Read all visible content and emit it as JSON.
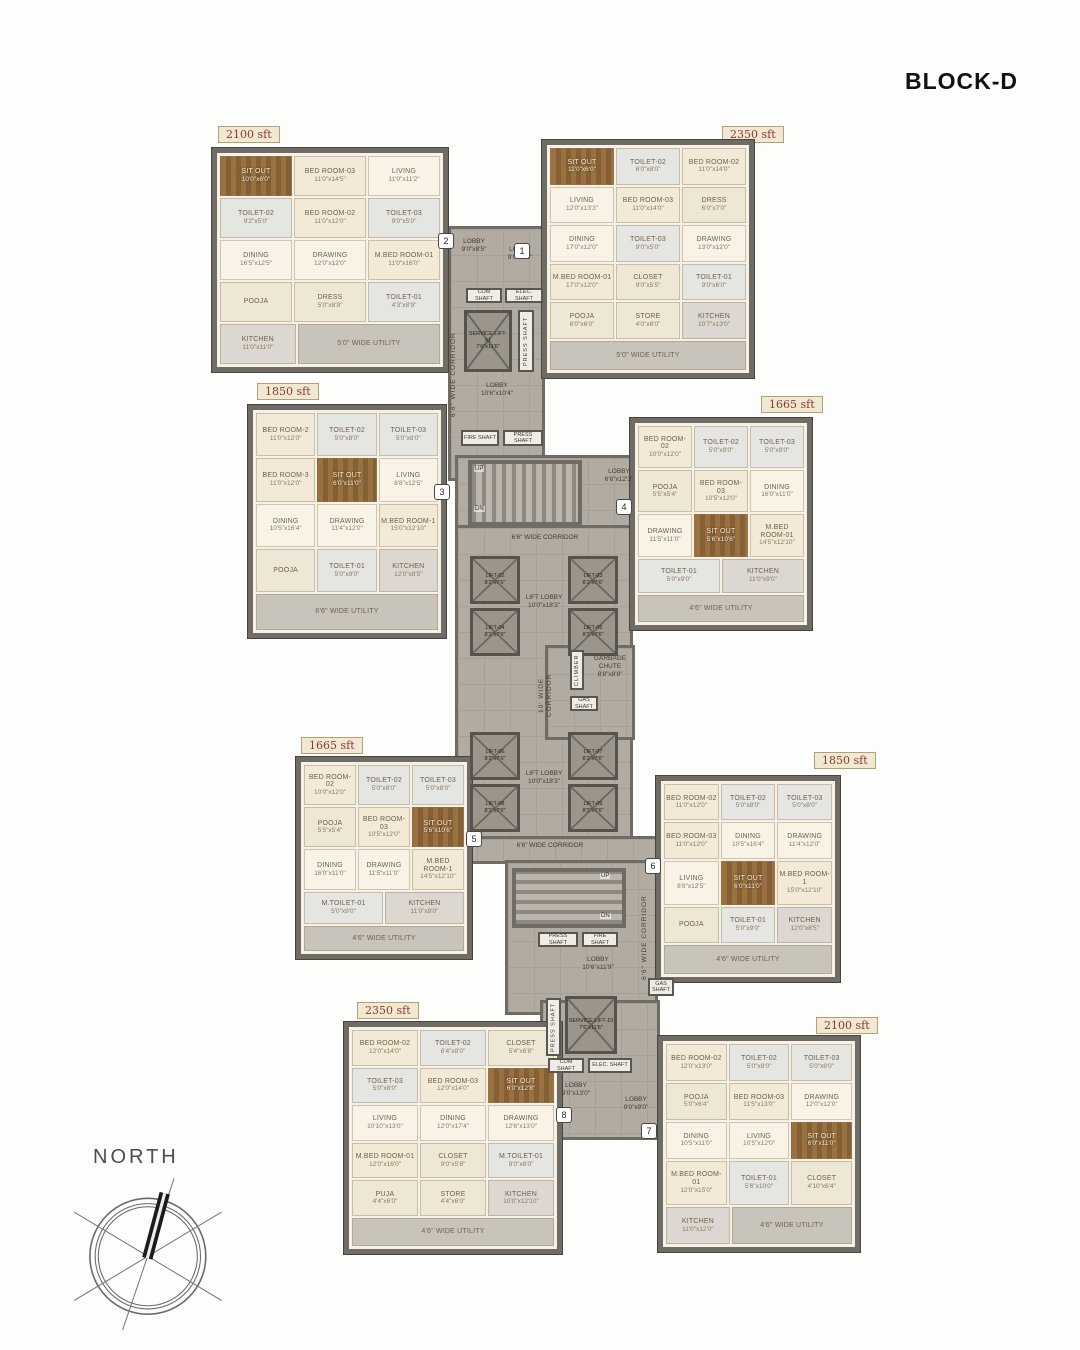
{
  "header": {
    "title": "BLOCK-D"
  },
  "compass": {
    "label": "NORTH"
  },
  "units": [
    {
      "area": "2350 sft",
      "tag": "1",
      "rooms": [
        {
          "n": "SIT OUT",
          "d": "11'0\"x6'0\"",
          "k": "sitout"
        },
        {
          "n": "TOILET-02",
          "d": "6'0\"x8'0\"",
          "k": "toilet"
        },
        {
          "n": "BED ROOM-02",
          "d": "11'0\"x14'0\"",
          "k": "bedroom"
        },
        {
          "n": "LIVING",
          "d": "12'0\"x13'3\"",
          "k": "living"
        },
        {
          "n": "BED ROOM-03",
          "d": "11'0\"x14'0\"",
          "k": "bedroom"
        },
        {
          "n": "DRESS",
          "d": "6'0\"x7'0\"",
          "k": "dress"
        },
        {
          "n": "DINING",
          "d": "17'0\"x12'0\"",
          "k": "living"
        },
        {
          "n": "TOILET-03",
          "d": "9'0\"x5'0\"",
          "k": "toilet"
        },
        {
          "n": "DRAWING",
          "d": "13'0\"x12'0\"",
          "k": "living"
        },
        {
          "n": "M.BED ROOM-01",
          "d": "17'0\"x12'0\"",
          "k": "bedroom"
        },
        {
          "n": "CLOSET",
          "d": "9'0\"x5'5\"",
          "k": "closet"
        },
        {
          "n": "TOILET-01",
          "d": "9'0\"x6'0\"",
          "k": "toilet"
        },
        {
          "n": "POOJA",
          "d": "6'0\"x6'0\"",
          "k": "pooja"
        },
        {
          "n": "STORE",
          "d": "4'0\"x6'0\"",
          "k": "store"
        },
        {
          "n": "KITCHEN",
          "d": "10'7\"x13'0\"",
          "k": "kitchen"
        },
        {
          "n": "5'0\" WIDE UTILITY",
          "k": "utility"
        }
      ]
    },
    {
      "area": "2100 sft",
      "tag": "2",
      "rooms": [
        {
          "n": "SIT OUT",
          "d": "10'0\"x6'0\"",
          "k": "sitout"
        },
        {
          "n": "BED ROOM-03",
          "d": "11'0\"x14'5\"",
          "k": "bedroom"
        },
        {
          "n": "LIVING",
          "d": "11'0\"x11'2\"",
          "k": "living"
        },
        {
          "n": "TOILET-02",
          "d": "9'2\"x5'0\"",
          "k": "toilet"
        },
        {
          "n": "BED ROOM-02",
          "d": "11'0\"x12'0\"",
          "k": "bedroom"
        },
        {
          "n": "TOILET-03",
          "d": "9'0\"x5'0\"",
          "k": "toilet"
        },
        {
          "n": "DINING",
          "d": "16'5\"x12'5\"",
          "k": "living"
        },
        {
          "n": "DRAWING",
          "d": "12'0\"x12'0\"",
          "k": "living"
        },
        {
          "n": "M.BED ROOM-01",
          "d": "11'0\"x16'0\"",
          "k": "bedroom"
        },
        {
          "n": "POOJA",
          "k": "pooja"
        },
        {
          "n": "DRESS",
          "d": "5'0\"x8'9\"",
          "k": "dress"
        },
        {
          "n": "TOILET-01",
          "d": "4'3\"x8'9\"",
          "k": "toilet"
        },
        {
          "n": "KITCHEN",
          "d": "11'0\"x11'0\"",
          "k": "kitchen"
        },
        {
          "n": "5'0\" WIDE UTILITY",
          "k": "utility"
        }
      ]
    },
    {
      "area": "1850 sft",
      "tag": "3",
      "rooms": [
        {
          "n": "BED ROOM-2",
          "d": "11'0\"x12'0\"",
          "k": "bedroom"
        },
        {
          "n": "TOILET-02",
          "d": "5'0\"x8'0\"",
          "k": "toilet"
        },
        {
          "n": "TOILET-03",
          "d": "5'0\"x8'0\"",
          "k": "toilet"
        },
        {
          "n": "BED ROOM-3",
          "d": "11'0\"x12'0\"",
          "k": "bedroom"
        },
        {
          "n": "SIT OUT",
          "d": "6'0\"x11'0\"",
          "k": "sitout"
        },
        {
          "n": "LIVING",
          "d": "8'8\"x12'5\"",
          "k": "living"
        },
        {
          "n": "DINING",
          "d": "10'5\"x16'4\"",
          "k": "living"
        },
        {
          "n": "DRAWING",
          "d": "11'4\"x12'0\"",
          "k": "living"
        },
        {
          "n": "M.BED ROOM-1",
          "d": "15'0\"x12'10\"",
          "k": "bedroom"
        },
        {
          "n": "POOJA",
          "k": "pooja"
        },
        {
          "n": "TOILET-01",
          "d": "5'0\"x9'0\"",
          "k": "toilet"
        },
        {
          "n": "KITCHEN",
          "d": "12'0\"x8'5\"",
          "k": "kitchen"
        },
        {
          "n": "6'6\" WIDE UTILITY",
          "k": "utility"
        }
      ]
    },
    {
      "area": "1665 sft",
      "tag": "4",
      "rooms": [
        {
          "n": "BED ROOM-02",
          "d": "10'0\"x12'0\"",
          "k": "bedroom"
        },
        {
          "n": "TOILET-02",
          "d": "5'0\"x8'0\"",
          "k": "toilet"
        },
        {
          "n": "TOILET-03",
          "d": "5'0\"x8'0\"",
          "k": "toilet"
        },
        {
          "n": "POOJA",
          "d": "5'5\"x5'4\"",
          "k": "pooja"
        },
        {
          "n": "BED ROOM-03",
          "d": "10'5\"x12'0\"",
          "k": "bedroom"
        },
        {
          "n": "DINING",
          "d": "16'0\"x11'0\"",
          "k": "living"
        },
        {
          "n": "DRAWING",
          "d": "11'5\"x11'0\"",
          "k": "living"
        },
        {
          "n": "SIT OUT",
          "d": "5'6\"x10'6\"",
          "k": "sitout"
        },
        {
          "n": "M.BED ROOM-01",
          "d": "14'5\"x12'10\"",
          "k": "bedroom"
        },
        {
          "n": "TOILET-01",
          "d": "5'0\"x9'0\"",
          "k": "toilet"
        },
        {
          "n": "KITCHEN",
          "d": "11'0\"x9'0\"",
          "k": "kitchen"
        },
        {
          "n": "4'6\" WIDE UTILITY",
          "k": "utility"
        }
      ]
    },
    {
      "area": "1665 sft",
      "tag": "5",
      "rooms": [
        {
          "n": "BED ROOM-02",
          "d": "10'0\"x12'0\"",
          "k": "bedroom"
        },
        {
          "n": "TOILET-02",
          "d": "5'0\"x8'0\"",
          "k": "toilet"
        },
        {
          "n": "TOILET-03",
          "d": "5'0\"x8'0\"",
          "k": "toilet"
        },
        {
          "n": "POOJA",
          "d": "5'5\"x5'4\"",
          "k": "pooja"
        },
        {
          "n": "BED ROOM-03",
          "d": "10'5\"x12'0\"",
          "k": "bedroom"
        },
        {
          "n": "SIT OUT",
          "d": "5'6\"x10'6\"",
          "k": "sitout"
        },
        {
          "n": "DINING",
          "d": "16'0\"x11'0\"",
          "k": "living"
        },
        {
          "n": "DRAWING",
          "d": "11'5\"x11'0\"",
          "k": "living"
        },
        {
          "n": "M.BED ROOM-1",
          "d": "14'5\"x12'10\"",
          "k": "bedroom"
        },
        {
          "n": "M.TOILET-01",
          "d": "5'0\"x9'0\"",
          "k": "toilet"
        },
        {
          "n": "KITCHEN",
          "d": "11'0\"x9'0\"",
          "k": "kitchen"
        },
        {
          "n": "4'6\" WIDE UTILITY",
          "k": "utility"
        }
      ]
    },
    {
      "area": "1850 sft",
      "tag": "6",
      "rooms": [
        {
          "n": "BED ROOM-02",
          "d": "11'0\"x12'0\"",
          "k": "bedroom"
        },
        {
          "n": "TOILET-02",
          "d": "5'0\"x8'0\"",
          "k": "toilet"
        },
        {
          "n": "TOILET-03",
          "d": "5'0\"x8'0\"",
          "k": "toilet"
        },
        {
          "n": "BED ROOM-03",
          "d": "11'0\"x12'0\"",
          "k": "bedroom"
        },
        {
          "n": "DINING",
          "d": "10'5\"x16'4\"",
          "k": "living"
        },
        {
          "n": "DRAWING",
          "d": "11'4\"x12'0\"",
          "k": "living"
        },
        {
          "n": "LIVING",
          "d": "8'8\"x12'5\"",
          "k": "living"
        },
        {
          "n": "SIT OUT",
          "d": "6'0\"x11'0\"",
          "k": "sitout"
        },
        {
          "n": "M.BED ROOM-1",
          "d": "15'0\"x12'10\"",
          "k": "bedroom"
        },
        {
          "n": "POOJA",
          "k": "pooja"
        },
        {
          "n": "TOILET-01",
          "d": "5'0\"x9'0\"",
          "k": "toilet"
        },
        {
          "n": "KITCHEN",
          "d": "12'0\"x8'5\"",
          "k": "kitchen"
        },
        {
          "n": "4'6\" WIDE UTILITY",
          "k": "utility"
        }
      ]
    },
    {
      "area": "2100 sft",
      "tag": "7",
      "rooms": [
        {
          "n": "BED ROOM-02",
          "d": "12'0\"x13'0\"",
          "k": "bedroom"
        },
        {
          "n": "TOILET-02",
          "d": "5'0\"x8'0\"",
          "k": "toilet"
        },
        {
          "n": "TOILET-03",
          "d": "5'0\"x8'0\"",
          "k": "toilet"
        },
        {
          "n": "POOJA",
          "d": "5'0\"x6'4\"",
          "k": "pooja"
        },
        {
          "n": "BED ROOM-03",
          "d": "11'5\"x13'0\"",
          "k": "bedroom"
        },
        {
          "n": "DRAWING",
          "d": "12'0\"x12'0\"",
          "k": "living"
        },
        {
          "n": "DINING",
          "d": "10'5\"x11'0\"",
          "k": "living"
        },
        {
          "n": "LIVING",
          "d": "10'5\"x12'0\"",
          "k": "living"
        },
        {
          "n": "SIT OUT",
          "d": "6'0\"x11'0\"",
          "k": "sitout"
        },
        {
          "n": "M.BED ROOM-01",
          "d": "12'0\"x15'0\"",
          "k": "bedroom"
        },
        {
          "n": "TOILET-01",
          "d": "5'6\"x10'0\"",
          "k": "toilet"
        },
        {
          "n": "CLOSET",
          "d": "4'10\"x6'4\"",
          "k": "closet"
        },
        {
          "n": "KITCHEN",
          "d": "11'0\"x12'0\"",
          "k": "kitchen"
        },
        {
          "n": "4'6\" WIDE UTILITY",
          "k": "utility"
        }
      ]
    },
    {
      "area": "2350 sft",
      "tag": "8",
      "rooms": [
        {
          "n": "BED ROOM-02",
          "d": "12'0\"x14'0\"",
          "k": "bedroom"
        },
        {
          "n": "TOILET-02",
          "d": "6'4\"x8'0\"",
          "k": "toilet"
        },
        {
          "n": "CLOSET",
          "d": "5'4\"x6'8\"",
          "k": "closet"
        },
        {
          "n": "TOILET-03",
          "d": "5'0\"x8'0\"",
          "k": "toilet"
        },
        {
          "n": "BED ROOM-03",
          "d": "12'0\"x14'0\"",
          "k": "bedroom"
        },
        {
          "n": "SIT OUT",
          "d": "6'0\"x12'8\"",
          "k": "sitout"
        },
        {
          "n": "LIVING",
          "d": "10'10\"x13'0\"",
          "k": "living"
        },
        {
          "n": "DINING",
          "d": "12'0\"x17'4\"",
          "k": "living"
        },
        {
          "n": "DRAWING",
          "d": "12'6\"x13'0\"",
          "k": "living"
        },
        {
          "n": "M.BED ROOM-01",
          "d": "12'0\"x16'0\"",
          "k": "bedroom"
        },
        {
          "n": "CLOSET",
          "d": "9'0\"x5'8\"",
          "k": "closet"
        },
        {
          "n": "M.TOILET-01",
          "d": "9'0\"x8'0\"",
          "k": "toilet"
        },
        {
          "n": "PUJA",
          "d": "4'4\"x6'0\"",
          "k": "pooja"
        },
        {
          "n": "STORE",
          "d": "4'4\"x6'0\"",
          "k": "store"
        },
        {
          "n": "KITCHEN",
          "d": "10'0\"x12'10\"",
          "k": "kitchen"
        },
        {
          "n": "4'6\" WIDE UTILITY",
          "k": "utility"
        }
      ]
    }
  ],
  "core": {
    "corridor_66": "6'6\" WIDE CORRIDOR",
    "corridor_10": "10' WIDE CORRIDOR",
    "lobby_1": {
      "name": "LOBBY",
      "dim": "9'0\"x8'5\""
    },
    "lobby_2": {
      "name": "LOBBY",
      "dim": "9'0\"x8'5\""
    },
    "lobby_top": {
      "name": "LOBBY",
      "dim": "10'6\"x10'4\""
    },
    "lobby_4": {
      "name": "LOBBY",
      "dim": "6'6\"x12'3\""
    },
    "lobby_mid": {
      "name": "LOBBY",
      "dim": "10'6\"x11'9\""
    },
    "lobby_8": {
      "name": "LOBBY",
      "dim": "9'0\"x13'0\""
    },
    "lobby_7": {
      "name": "LOBBY",
      "dim": "9'0\"x9'0\""
    },
    "lift_lobby": {
      "name": "LIFT LOBBY",
      "dim": "10'0\"x18'3\""
    },
    "com_shaft": "COM SHAFT",
    "elec_shaft": "ELEC. SHAFT",
    "press_shaft": "PRESS SHAFT",
    "fire_shaft": "FIRE SHAFT",
    "gas_shaft": "GAS SHAFT",
    "climber": "CLIMBER",
    "garbage_chute": {
      "name": "GARBAGE CHUTE",
      "dim": "8'8\"x8'8\""
    },
    "service_lift_01": {
      "n": "SERVICE LIFT-01",
      "d": "7'6\"x11'6\""
    },
    "service_lift_10": {
      "n": "SERVICE LIFT-10",
      "d": "7'6\"x11'6\""
    },
    "stairs": {
      "up": "UP",
      "dn": "DN"
    },
    "lifts_a": [
      {
        "n": "LIFT-02",
        "d": "8'2\"x7'6\""
      },
      {
        "n": "LIFT-03",
        "d": "8'2\"x7'6\""
      },
      {
        "n": "LIFT-04",
        "d": "8'2\"x7'6\""
      },
      {
        "n": "LIFT-05",
        "d": "8'2\"x7'6\""
      }
    ],
    "lifts_b": [
      {
        "n": "LIFT-06",
        "d": "8'2\"x7'6\""
      },
      {
        "n": "LIFT-07",
        "d": "8'2\"x7'6\""
      },
      {
        "n": "LIFT-08",
        "d": "8'2\"x7'6\""
      },
      {
        "n": "LIFT-09",
        "d": "8'2\"x7'6\""
      }
    ],
    "tags": [
      "1",
      "2",
      "3",
      "4",
      "5",
      "6",
      "7",
      "8"
    ]
  },
  "colors": {
    "wall": "#6f6c66",
    "corridor": "#b2aba2",
    "floor": "#f7f1e5",
    "badge_text": "#8c3a2a",
    "wood": "#9a713f"
  }
}
